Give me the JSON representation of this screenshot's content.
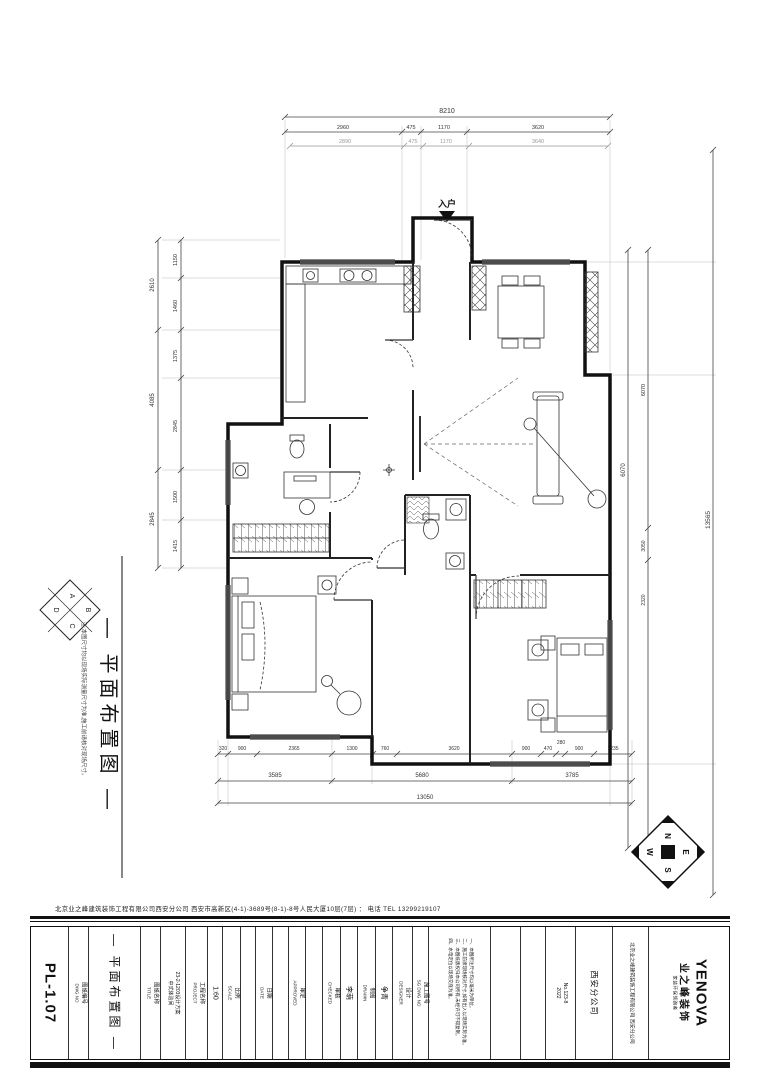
{
  "sheet": {
    "number": "PL-1.07",
    "entry_label": "入户",
    "address_line": "北京业之峰建筑装饰工程有限公司西安分公司 西安市高新区(4-1)-3689号(8-1)-8号人民大厦10层(7层) ： 电话 TEL 13299219107"
  },
  "dims": {
    "top": {
      "total": "8210",
      "segments": [
        "2960",
        "475",
        "1170",
        "3620"
      ],
      "segments2": [
        "2890",
        "475",
        "1170",
        "3640"
      ]
    },
    "left": {
      "outer": [
        "2610",
        "4085",
        "2845"
      ],
      "inner": [
        "1150",
        "1460",
        "1375",
        "2845",
        "1500",
        "1415"
      ]
    },
    "right": {
      "inner": [
        "6070"
      ],
      "inner2": [
        "6070",
        "3050",
        "2320"
      ],
      "outer": "13565"
    },
    "bottom": {
      "segments": [
        "320",
        "900",
        "2365",
        "1300",
        "760",
        "3620",
        "900",
        "470",
        "280",
        "900",
        "1235"
      ],
      "subtotals": [
        "3585",
        "5680",
        "3785"
      ],
      "total": "13050"
    }
  },
  "side_panel": {
    "title": "— 平面布置图 —",
    "note": "注:本图尺寸均以现场实际测量尺寸为准,施工前请核对现场尺寸。",
    "index_letters": [
      "A",
      "B",
      "C",
      "D"
    ]
  },
  "compass": {
    "n": "N",
    "e": "E",
    "s": "S",
    "w": "W"
  },
  "titleblock": {
    "labels": {
      "dwg_no_cn": "图纸编号",
      "dwg_no_en": "DWG NO",
      "title_cn": "图纸名称",
      "title_en": "TITLE",
      "project_cn": "工程名称",
      "project_en": "PROJECT",
      "scale_cn": "比例",
      "scale_en": "SCALE",
      "date_cn": "日期",
      "date_en": "DATE",
      "approved_cn": "审定",
      "approved_en": "APPROVED",
      "checked_cn": "审核",
      "checked_en": "CHECKED",
      "drawn_cn": "制图",
      "drawn_en": "DRAWN",
      "designer_cn": "设计",
      "designer_en": "DESIGNER",
      "job_no_cn": "施工图号",
      "job_no_en": "SG DWG NO"
    },
    "values": {
      "title": "— 平面布置图 —",
      "project_line1": "23-2-1203设计方案",
      "project_line2": "中式体验间",
      "scale": "1:60",
      "drawn": "李萌",
      "designer": "争青",
      "doc_no": "No.123-8",
      "doc_year": "2022",
      "branch": "西安分公司"
    },
    "notes": [
      "一、本图所注尺寸均以毫米为单位。",
      "二、施工前须现场核对尺寸,如有出入以现场实际为准。",
      "三、本图纸版权归本公司所有,未经许可不得复制。",
      "四、水电定位以现场交底为准。"
    ],
    "logo": {
      "en": "YENOVA",
      "cn": "业之峰装饰",
      "tagline": "家装环保领跑者",
      "company": "北京业之峰建筑装饰工程有限公司 西安分公司"
    }
  }
}
